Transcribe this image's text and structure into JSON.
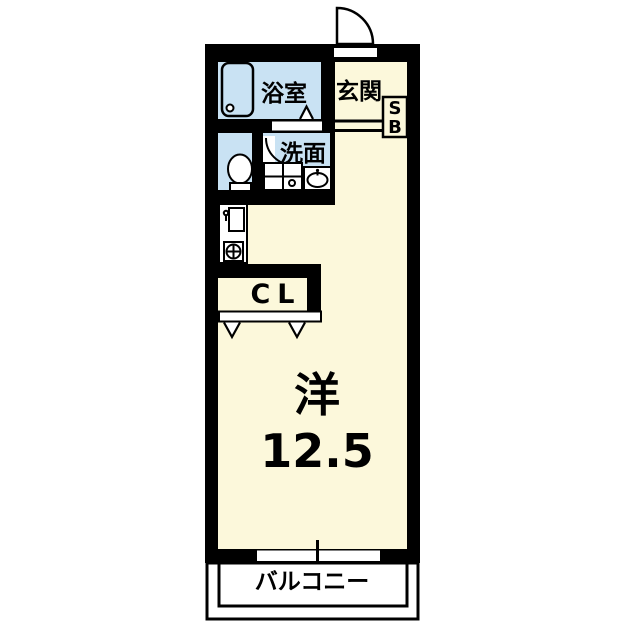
{
  "palette": {
    "wall": "#000000",
    "floor": "#FCF8DB",
    "wet_area": "#C9E2F3",
    "fixture_fill": "#FFFFFF",
    "background": "#FFFFFF"
  },
  "rooms": {
    "bathroom": {
      "label": "浴室"
    },
    "entrance": {
      "label": "玄関"
    },
    "shoe_box": {
      "line1": "S",
      "line2": "B"
    },
    "washroom": {
      "label": "洗面"
    },
    "closet": {
      "label": "CL"
    },
    "western_room": {
      "label": "洋",
      "size": "12.5"
    },
    "balcony": {
      "label": "バルコニー"
    }
  },
  "fixtures": {
    "bathtub": "bathtub-icon",
    "toilet": "toilet-icon",
    "washing_machine_pan": "washing-machine-pan-icon",
    "wash_basin": "wash-basin-icon",
    "kitchen_sink": "kitchen-sink-icon",
    "stove_burner": "stove-burner-icon",
    "entrance_door": "entrance-door-arc",
    "washroom_door": "washroom-door-arc",
    "bathroom_door_mark": "folding-door-mark",
    "closet_doors": "folding-door-marks",
    "balcony_window": "sliding-window"
  }
}
